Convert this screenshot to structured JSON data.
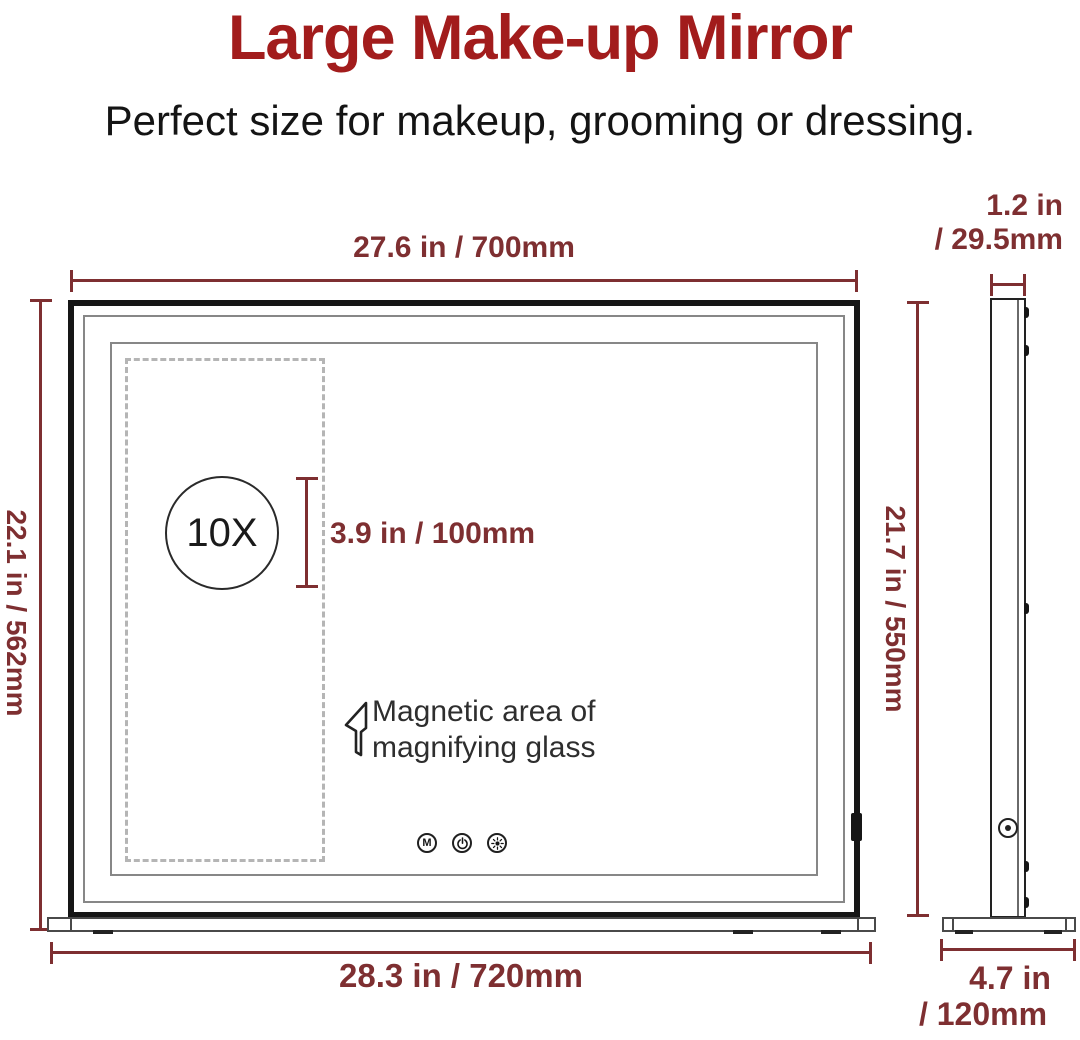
{
  "header": {
    "title": "Large Make-up Mirror",
    "subtitle": "Perfect size for makeup, grooming or dressing."
  },
  "colors": {
    "title_red": "#A21C1C",
    "dimension_red": "#7E2F31",
    "frame_black": "#161616",
    "dashed_area_gray": "#B5B5B5"
  },
  "front_view": {
    "top_width_label": "27.6 in / 700mm",
    "left_height_label": "22.1 in / 562mm",
    "bottom_width_label": "28.3 in / 720mm",
    "magnifier_label": "10X",
    "magnifier_height_label": "3.9 in / 100mm",
    "magnetic_note": [
      "Magnetic area of",
      "magnifying glass"
    ],
    "buttons": {
      "mode": "M",
      "power": "power-icon",
      "light": "light-icon"
    }
  },
  "side_view": {
    "top_depth_label": [
      "1.2 in",
      "/ 29.5mm"
    ],
    "height_label": "21.7 in / 550mm",
    "base_depth_label": [
      "4.7 in",
      "/ 120mm"
    ]
  }
}
